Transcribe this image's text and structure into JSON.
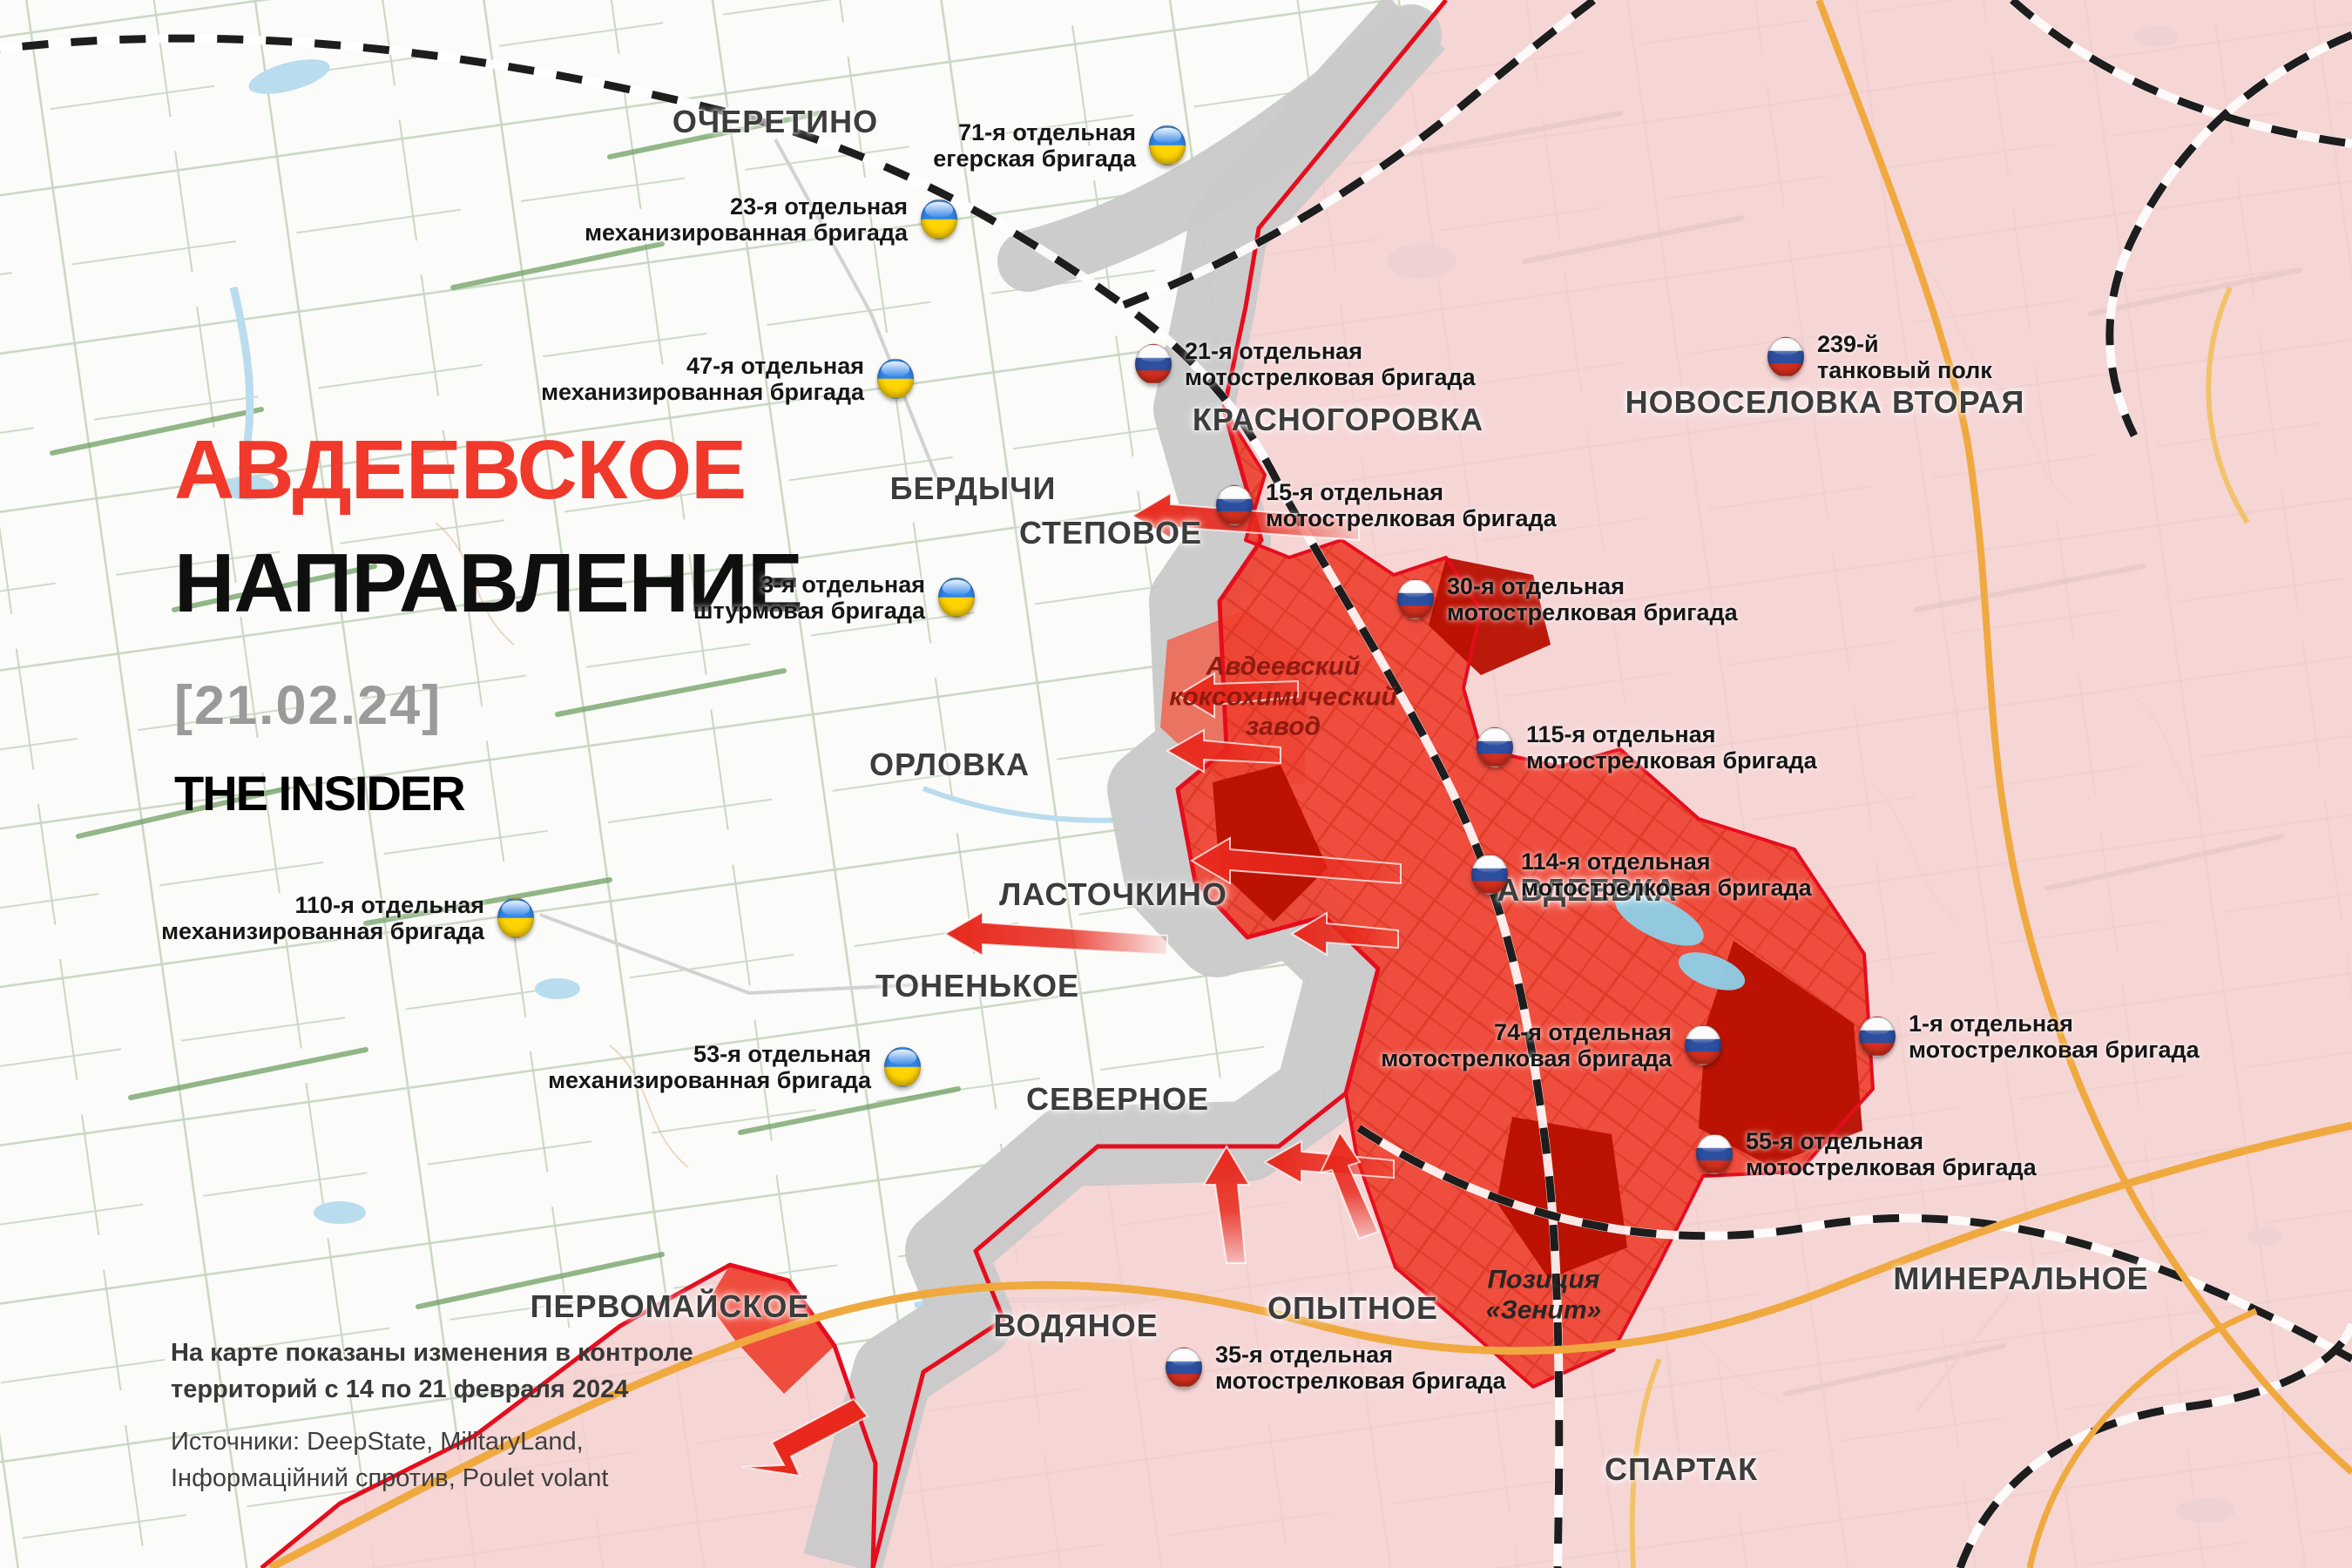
{
  "title": {
    "line1": "АВДЕЕВСКОЕ",
    "line2": "НАПРАВЛЕНИЕ",
    "date": "[21.02.24]",
    "brand": "THE INSIDER"
  },
  "footer": {
    "note_line1": "На карте показаны изменения в контроле",
    "note_line2": "территорий с 14 по 21 февраля 2024",
    "sources_line1": "Источники: DeepState, MilitaryLand,",
    "sources_line2": "Інформаційний спротив, Poulet volant"
  },
  "towns": [
    {
      "name": "ОЧЕРЕТИНО"
    },
    {
      "name": "КРАСНОГОРОВКА"
    },
    {
      "name": "НОВОСЕЛОВКА ВТОРАЯ"
    },
    {
      "name": "БЕРДЫЧИ"
    },
    {
      "name": "СТЕПОВОЕ"
    },
    {
      "name": "ОРЛОВКА"
    },
    {
      "name": "АВДЕЕВКА"
    },
    {
      "name": "ЛАСТОЧКИНО"
    },
    {
      "name": "ТОНЕНЬКОЕ"
    },
    {
      "name": "СЕВЕРНОЕ"
    },
    {
      "name": "ПЕРВОМАЙСКОЕ"
    },
    {
      "name": "ВОДЯНОЕ"
    },
    {
      "name": "ОПЫТНОЕ"
    },
    {
      "name": "МИНЕРАЛЬНОЕ"
    },
    {
      "name": "СПАРТАК"
    }
  ],
  "units": [
    {
      "line1": "71-я отдельная",
      "line2": "егерская бригада",
      "country": "ua"
    },
    {
      "line1": "23-я отдельная",
      "line2": "механизированная бригада",
      "country": "ua"
    },
    {
      "line1": "47-я отдельная",
      "line2": "механизированная бригада",
      "country": "ua"
    },
    {
      "line1": "3-я отдельная",
      "line2": "штурмовая бригада",
      "country": "ua"
    },
    {
      "line1": "110-я отдельная",
      "line2": "механизированная бригада",
      "country": "ua"
    },
    {
      "line1": "53-я отдельная",
      "line2": "механизированная бригада",
      "country": "ua"
    },
    {
      "line1": "21-я отдельная",
      "line2": "мотострелковая бригада",
      "country": "ru"
    },
    {
      "line1": "15-я отдельная",
      "line2": "мотострелковая бригада",
      "country": "ru"
    },
    {
      "line1": "30-я отдельная",
      "line2": "мотострелковая бригада",
      "country": "ru"
    },
    {
      "line1": "115-я отдельная",
      "line2": "мотострелковая бригада",
      "country": "ru"
    },
    {
      "line1": "114-я отдельная",
      "line2": "мотострелковая бригада",
      "country": "ru"
    },
    {
      "line1": "239-й",
      "line2": "танковый полк",
      "country": "ru"
    },
    {
      "line1": "74-я отдельная",
      "line2": "мотострелковая бригада",
      "country": "ru"
    },
    {
      "line1": "1-я отдельная",
      "line2": "мотострелковая бригада",
      "country": "ru"
    },
    {
      "line1": "55-я отдельная",
      "line2": "мотострелковая бригада",
      "country": "ru"
    },
    {
      "line1": "35-я отдельная",
      "line2": "мотострелковая бригада",
      "country": "ru"
    }
  ],
  "poi": [
    {
      "line1": "Авдеевский",
      "line2": "коксохимический",
      "line3": "завод"
    },
    {
      "line1": "Позиция",
      "line2": "«Зенит»"
    }
  ],
  "colors": {
    "accent_red": "#f0392b",
    "frontline_red": "#e50d1d",
    "ru_controlled_pink": "#f5cfcf",
    "advance_red": "#ee4130",
    "recent_advance_dark_red": "#b70f00",
    "gray_zone": "#c9c9c9",
    "ua_flag_blue": "#2f85e8",
    "ua_flag_yellow": "#ffd400",
    "ru_flag_blue": "#2d4fa0",
    "ru_flag_red": "#d42f1e"
  }
}
